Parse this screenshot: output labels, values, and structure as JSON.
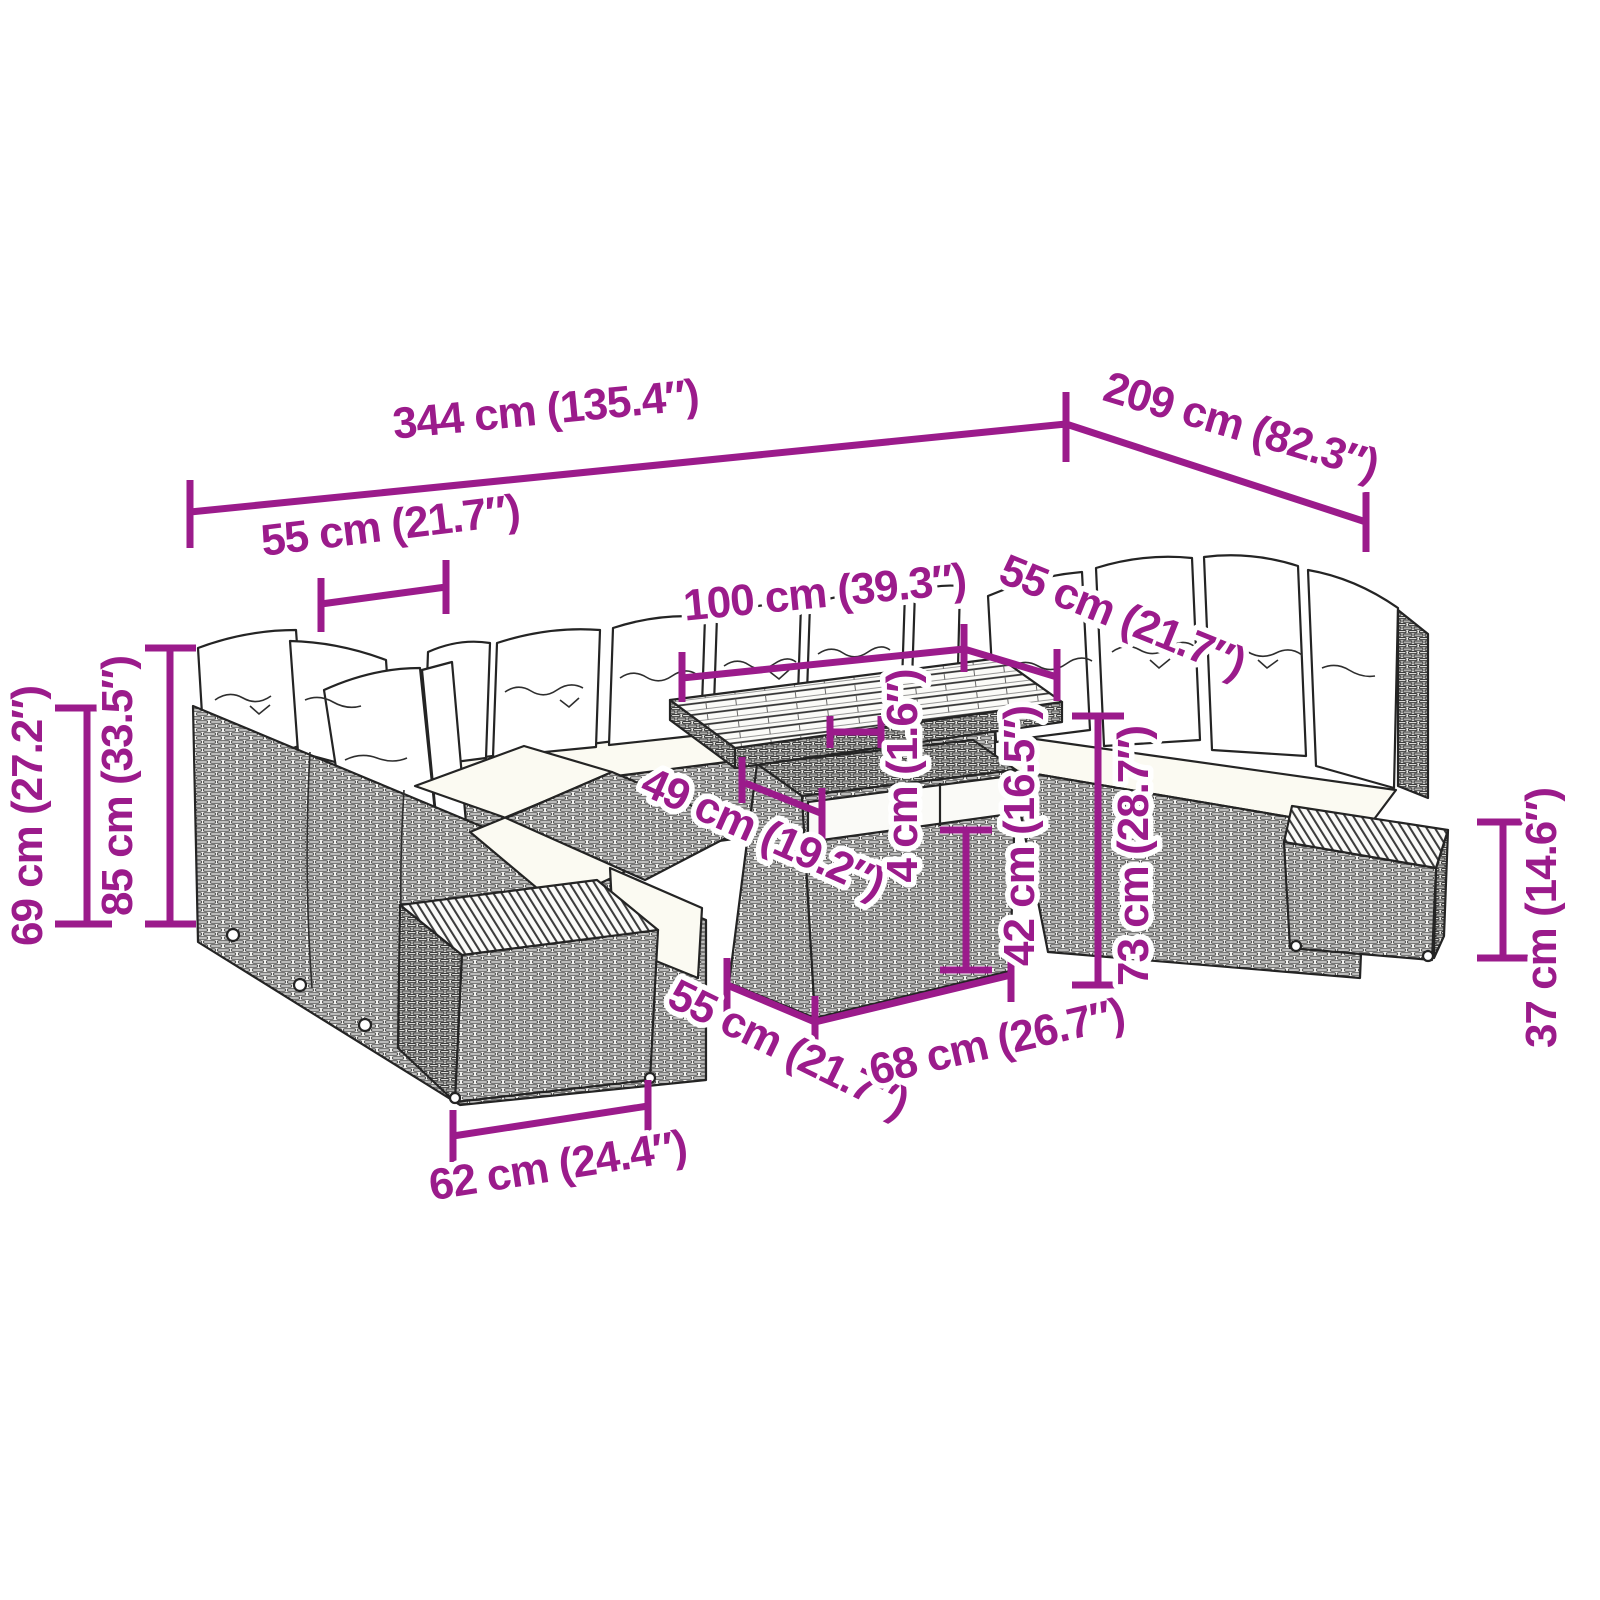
{
  "diagram": {
    "kind": "product-dimension-diagram",
    "subject": "poly rattan garden lounge set with cushions, slatted-top table and footstools",
    "background_color": "#ffffff",
    "line_art_color": "#242424",
    "dimension_accent_color": "#9B1B8B",
    "units": [
      "cm",
      "inches"
    ]
  },
  "dims": {
    "d344": {
      "cm": 344,
      "inches": 135.4,
      "label": "344 cm (135.4″)"
    },
    "d209": {
      "cm": 209,
      "inches": 82.3,
      "label": "209 cm (82.3″)"
    },
    "d55_left": {
      "cm": 55,
      "inches": 21.7,
      "label": "55 cm (21.7″)"
    },
    "d100": {
      "cm": 100,
      "inches": 39.3,
      "label": "100 cm (39.3″)"
    },
    "d55_right": {
      "cm": 55,
      "inches": 21.7,
      "label": "55 cm (21.7″)"
    },
    "d69": {
      "cm": 69,
      "inches": 27.2,
      "label": "69 cm (27.2″)"
    },
    "d85": {
      "cm": 85,
      "inches": 33.5,
      "label": "85 cm (33.5″)"
    },
    "d49": {
      "cm": 49,
      "inches": 19.2,
      "label": "49 cm (19.2″)"
    },
    "d4": {
      "cm": 4,
      "inches": 1.6,
      "label": "4 cm (1.6″)"
    },
    "d42": {
      "cm": 42,
      "inches": 16.5,
      "label": "42 cm (16.5″)"
    },
    "d73": {
      "cm": 73,
      "inches": 28.7,
      "label": "73 cm (28.7″)"
    },
    "d37": {
      "cm": 37,
      "inches": 14.6,
      "label": "37 cm (14.6″)"
    },
    "d55_table": {
      "cm": 55,
      "inches": 21.7,
      "label": "55 cm (21.7″)"
    },
    "d68": {
      "cm": 68,
      "inches": 26.7,
      "label": "68 cm (26.7″)"
    },
    "d62": {
      "cm": 62,
      "inches": 24.4,
      "label": "62 cm (24.4″)"
    }
  }
}
